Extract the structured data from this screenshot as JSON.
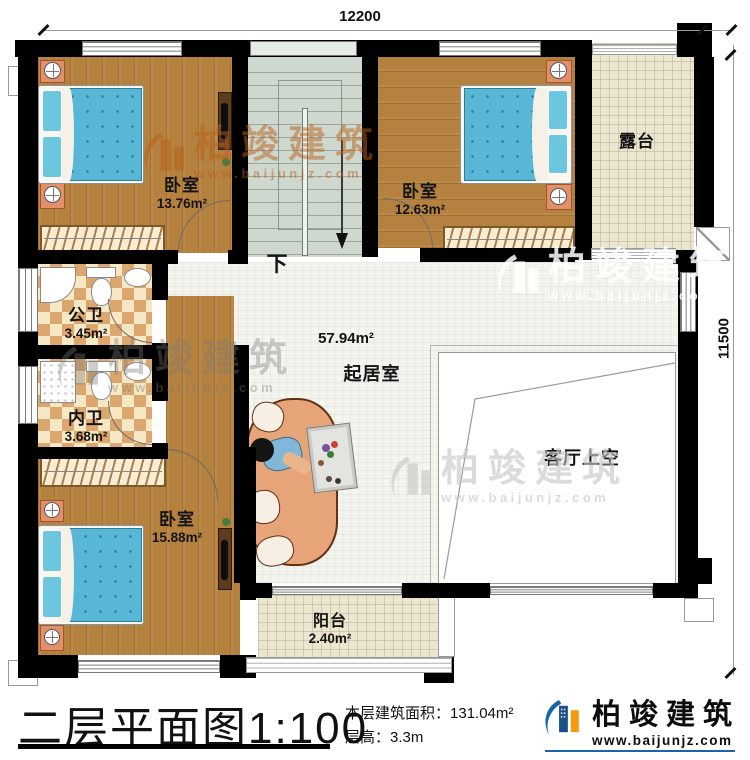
{
  "dimensions": {
    "top": "12200",
    "right": "11500"
  },
  "rooms": {
    "bedroom_top_left": {
      "name": "卧室",
      "area": "13.76m²"
    },
    "bedroom_top_right": {
      "name": "卧室",
      "area": "12.63m²"
    },
    "bedroom_bottom_left": {
      "name": "卧室",
      "area": "15.88m²"
    },
    "terrace": {
      "name": "露台"
    },
    "public_bathroom": {
      "name": "公卫",
      "area": "3.45m²"
    },
    "private_bathroom": {
      "name": "内卫",
      "area": "3.68m²"
    },
    "living_room": {
      "name": "起居室",
      "area": "57.94m²"
    },
    "living_void": {
      "name": "客厅上空"
    },
    "balcony": {
      "name": "阳台",
      "area": "2.40m²"
    }
  },
  "stairs": {
    "direction_label": "下"
  },
  "title_block": {
    "plan_title": "二层平面图",
    "scale": "1:100",
    "floor_area_label": "本层建筑面积：",
    "floor_area_value": "131.04m²",
    "floor_height_label": "层高：",
    "floor_height_value": "3.3m"
  },
  "brand": {
    "company": "柏竣建筑",
    "website": "www.baijunjz.com"
  },
  "colors": {
    "wall": "#000000",
    "wood_floor": "#b5813f",
    "tile_light": "#f6e8c4",
    "tile_dark": "#dca76e",
    "terrace_floor": "#ebe6d0",
    "stairs_floor": "#ced8ce",
    "bed_blue": "#58b6d6",
    "logo_blue": "#1766ad",
    "logo_orange": "#f39c12"
  }
}
